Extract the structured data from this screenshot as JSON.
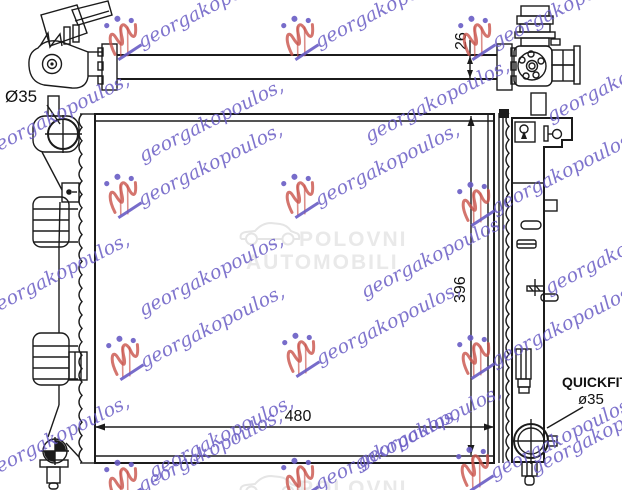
{
  "dimensions": {
    "pipe_thickness": "26",
    "height": "396",
    "width": "480",
    "inlet": "Ø35",
    "quickfit_label": "QUICKFIT",
    "quickfit_size": "ø35"
  },
  "watermarks": {
    "script_text": "georgakopoulos,",
    "center": {
      "line1": "POLOVNI",
      "line2": "AUTOMOBILI"
    },
    "colors": {
      "script_blue": "#685cc4",
      "logo_red": "#c9524a",
      "center_gray": "#e9e9e9"
    }
  }
}
